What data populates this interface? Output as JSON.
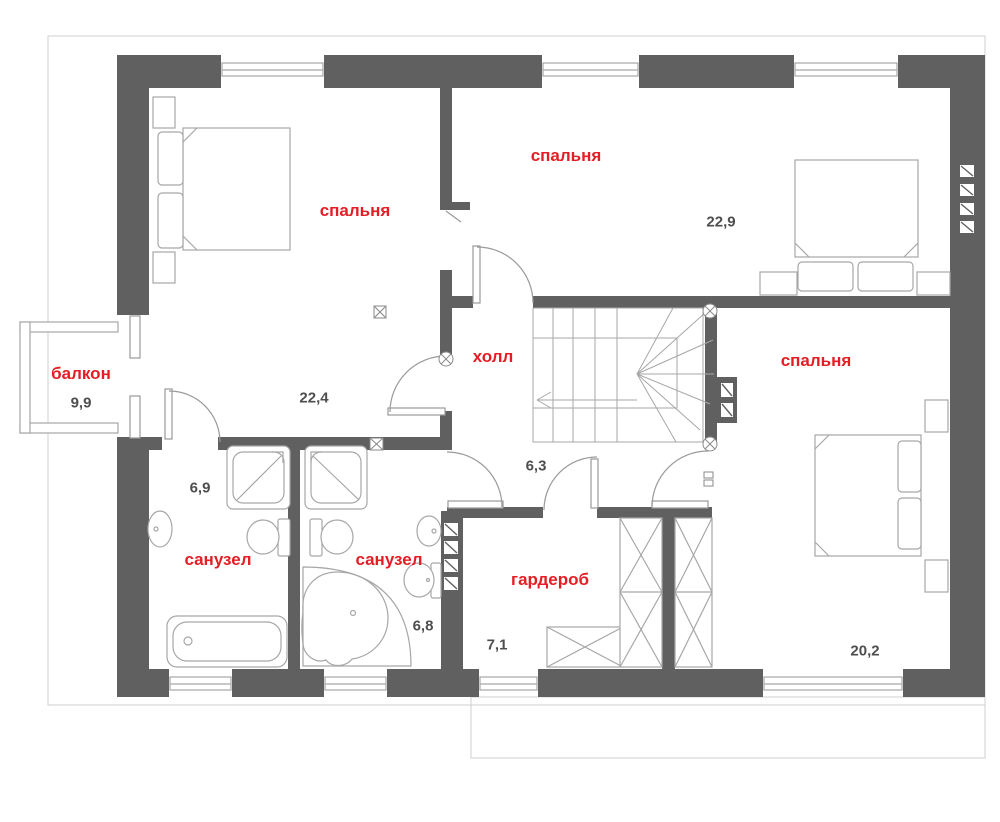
{
  "colors": {
    "wall": "#606060",
    "label_red": "#e31e24",
    "area_gray": "#4e4e4e",
    "furniture": "#a7a7a7",
    "door": "#9a9a9a",
    "outline": "#cfcfcf"
  },
  "rooms": {
    "bedroom_top_left": {
      "label": "спальня",
      "area": "22,4"
    },
    "bedroom_top_right": {
      "label": "спальня",
      "area": "22,9"
    },
    "bedroom_right": {
      "label": "спальня",
      "area": "20,2"
    },
    "hall": {
      "label": "холл",
      "area": "6,3"
    },
    "balcony": {
      "label": "балкон",
      "area": "9,9"
    },
    "bathroom_left": {
      "label": "санузел",
      "area": "6,9"
    },
    "bathroom_right": {
      "label": "санузел",
      "area": "6,8"
    },
    "wardrobe": {
      "label": "гардероб",
      "area": "7,1"
    }
  }
}
